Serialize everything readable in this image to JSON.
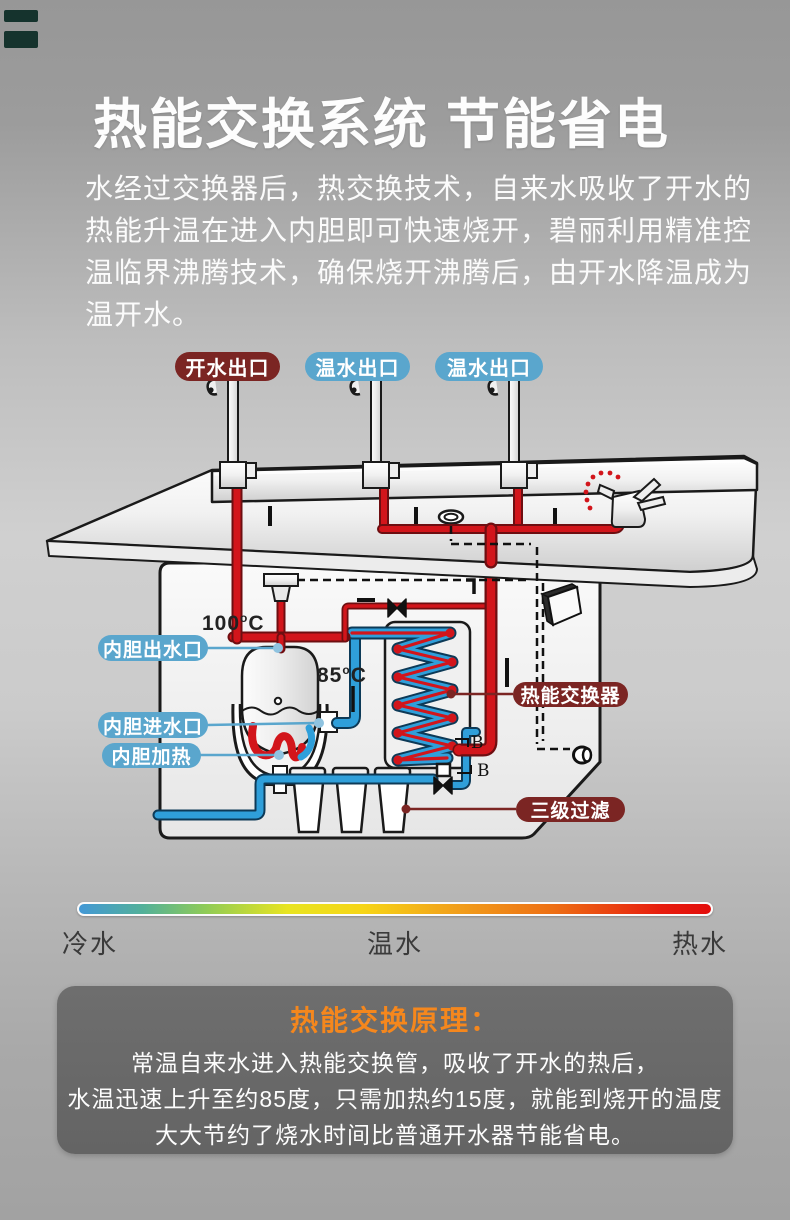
{
  "header": {
    "title": "热能交换系统  节能省电"
  },
  "intro": {
    "lines": [
      "水经过交换器后，热交换技术，自来水吸收了开水的",
      "热能升温在进入内胆即可快速烧开，碧丽利用精准控",
      "温临界沸腾技术，确保烧开沸腾后，由开水降温成为",
      "温开水。"
    ]
  },
  "diagram": {
    "outlets": [
      {
        "label": "开水出口",
        "color": "#7b2523"
      },
      {
        "label": "温水出口",
        "color": "#5aa6cd"
      },
      {
        "label": "温水出口",
        "color": "#5aa6cd"
      }
    ],
    "parts": {
      "tank_outlet": "内胆出水口",
      "tank_inlet": "内胆进水口",
      "tank_heater": "内胆加热",
      "heat_exchanger": "热能交换器",
      "filter": "三级过滤"
    },
    "temperatures": {
      "boiling": {
        "value": "100",
        "degree": "o",
        "unit": "C"
      },
      "preheated": {
        "value": "85",
        "degree": "o",
        "unit": "C"
      }
    },
    "section_marks": [
      "B",
      "B"
    ],
    "colors": {
      "hot_pipe": "#d2151b",
      "cold_pipe": "#2f9fda",
      "label_red": "#7b2523",
      "label_blue": "#5aa6cd"
    }
  },
  "legend": {
    "cold": "冷水",
    "warm": "温水",
    "hot": "热水",
    "gradient": [
      "#4398d6",
      "#52b09a",
      "#8fcb57",
      "#e8e421",
      "#f19e1b",
      "#e71d0e"
    ]
  },
  "principle": {
    "title": "热能交换原理：",
    "accent": "#f5871d",
    "lines": [
      "常温自来水进入热能交换管，吸收了开水的热后，",
      "水温迅速上升至约85度，只需加热约15度，就能到烧开的温度",
      "大大节约了烧水时间比普通开水器节能省电。"
    ]
  }
}
